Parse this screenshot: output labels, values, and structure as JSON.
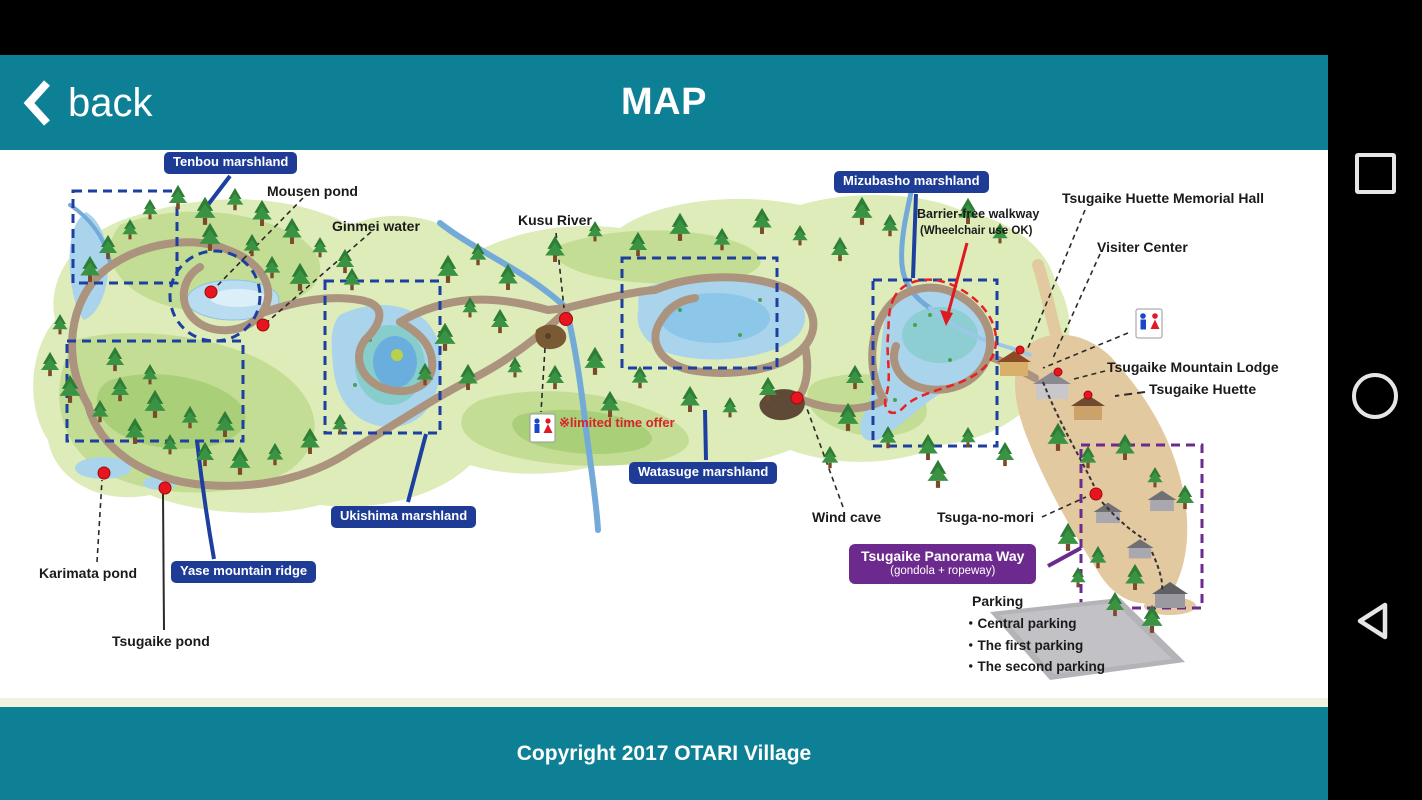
{
  "header": {
    "back_label": "back",
    "title": "MAP"
  },
  "footer": {
    "copyright": "Copyright 2017 OTARI Village"
  },
  "nav": {
    "recents_icon": "square-icon",
    "home_icon": "circle-icon",
    "back_icon": "triangle-left-icon"
  },
  "map": {
    "labels": {
      "tenbou": "Tenbou marshland",
      "mousen_pond": "Mousen pond",
      "ginmei_water": "Ginmei water",
      "kusu_river": "Kusu River",
      "limited_offer": "※limited time offer",
      "mizubasho": "Mizubasho marshland",
      "barrier_free_line1": "Barrier-free walkway",
      "barrier_free_line2": "(Wheelchair use OK)",
      "memorial_hall": "Tsugaike Huette Memorial Hall",
      "visitor_center": "Visiter Center",
      "mountain_lodge": "Tsugaike Mountain Lodge",
      "tsugaike_huette": "Tsugaike Huette",
      "watasuge": "Watasuge marshland",
      "wind_cave": "Wind cave",
      "tsuga_no_mori": "Tsuga-no-mori",
      "panorama_way_line1": "Tsugaike Panorama Way",
      "panorama_way_line2": "(gondola + ropeway)",
      "parking_title": "Parking",
      "parking_items": [
        "・Central parking",
        "・The first parking",
        "・The second parking"
      ],
      "ukishima": "Ukishima marshland",
      "yase": "Yase mountain ridge",
      "karimata_pond": "Karimata pond",
      "tsugaike_pond": "Tsugaike pond"
    },
    "colors": {
      "app_teal": "#0e8095",
      "label_blue": "#1e3c96",
      "label_purple": "#6d2a8e",
      "marker_red": "#e8141e"
    }
  }
}
